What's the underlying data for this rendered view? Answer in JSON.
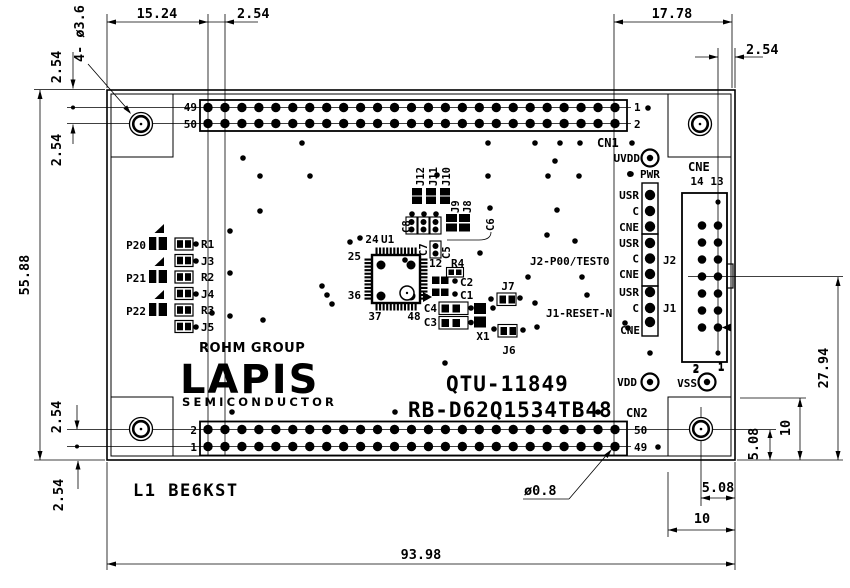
{
  "dims": {
    "w1": "15.24",
    "p": "2.54",
    "w2": "17.78",
    "h": "55.88",
    "h2": "27.94",
    "ten": "10",
    "five08": "5.08",
    "total": "93.98",
    "holes": "4- ø3.6",
    "pin": "ø0.8"
  },
  "cn1": {
    "label": "CN1",
    "tl": "49",
    "bl": "50",
    "tr": "1",
    "br": "2"
  },
  "cn2": {
    "label": "CN2",
    "tl": "2",
    "bl": "1",
    "tr": "50",
    "br": "49"
  },
  "cne": {
    "label": "CNE",
    "t14": "14",
    "t13": "13",
    "b2": "2",
    "b1": "1"
  },
  "strip": {
    "rows": [
      "USR",
      "C",
      "CNE",
      "USR",
      "C",
      "CNE",
      "USR",
      "C",
      "CNE"
    ],
    "j2": "J2",
    "j1": "J1"
  },
  "power": {
    "uvdd": "UVDD",
    "pwr": "PWR",
    "vdd": "VDD",
    "vss": "VSS",
    "vss2": "2",
    "vss1": "1"
  },
  "signals": {
    "j2": "J2-P00/TEST0",
    "j1": "J1-RESET-N"
  },
  "leds": {
    "p20": "P20",
    "p21": "P21",
    "p22": "P22"
  },
  "rcol": {
    "r1": "R1",
    "j3": "J3",
    "r2": "R2",
    "j4": "J4",
    "r3": "R3",
    "j5": "J5"
  },
  "ic": {
    "u1": "U1",
    "p24": "24",
    "p25": "25",
    "p36": "36",
    "p37": "37",
    "p48": "48",
    "p12": "12"
  },
  "parts": {
    "r4": "R4",
    "c1": "C1",
    "c2": "C2",
    "c3": "C3",
    "c4": "C4",
    "c5": "C5",
    "c6": "C6",
    "c7": "C7",
    "c8": "C8",
    "x1": "X1",
    "j6": "J6",
    "j7": "J7",
    "j8": "J8",
    "j9": "J9",
    "j10": "J10",
    "j11": "J11",
    "j12": "J12"
  },
  "brand": {
    "rohm": "ROHM GROUP",
    "lapis": "LAPIS",
    "semi": "SEMICONDUCTOR"
  },
  "title": {
    "model": "QTU-11849",
    "part": "RB-D62Q1534TB48",
    "note": "L1 BE6KST"
  }
}
